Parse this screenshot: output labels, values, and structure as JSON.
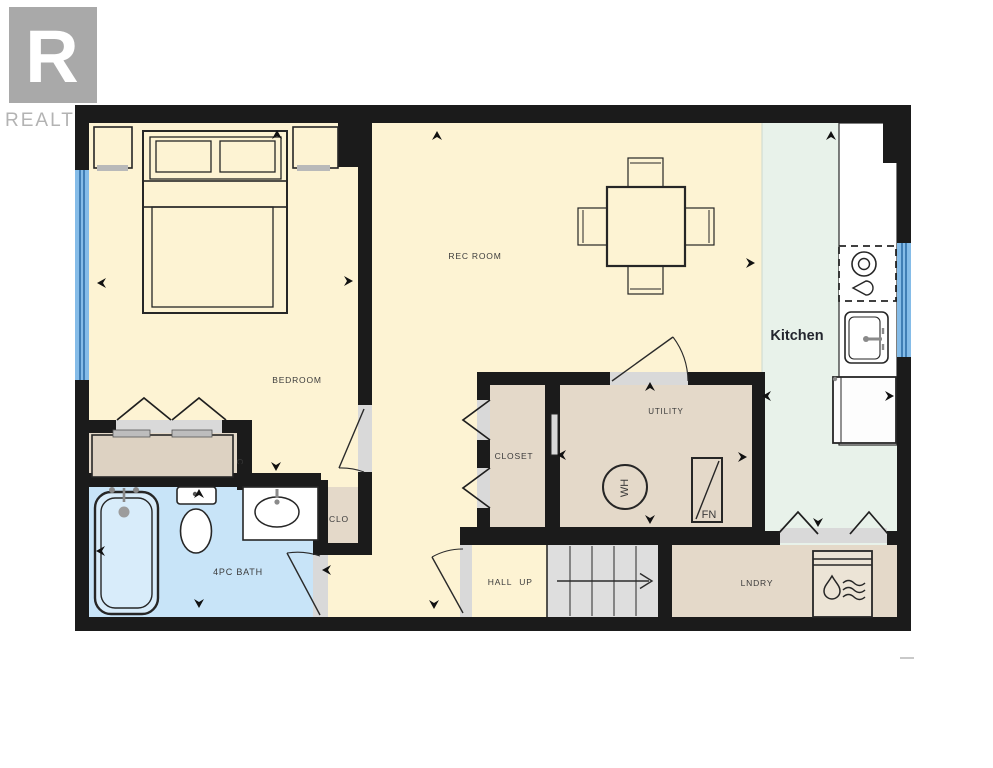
{
  "logo": {
    "letter": "R",
    "brand": "REALTOR",
    "registered_mark": "®"
  },
  "labels": {
    "bedroom": "BEDROOM",
    "rec_room": "REC ROOM",
    "kitchen": "Kitchen",
    "utility": "UTILITY",
    "closet": "CLOSET",
    "closet_small": "CLO",
    "closet_letter": "C",
    "bathroom": "4PC BATH",
    "hall": "HALL",
    "up": "UP",
    "laundry": "LNDRY",
    "water_heater": "WH",
    "furnace": "FN"
  },
  "colors": {
    "wall": "#1b1b1b",
    "floor_main": "#fdf3d3",
    "floor_service": "#e4d9c9",
    "floor_kitchen": "#e8f2ea",
    "floor_bath": "#c8e4f8",
    "counter_white": "#ffffff",
    "window_fill": "#85bce8",
    "window_line": "#2f6ea8",
    "stairs": "#dedede",
    "opening": "#d9d9d9",
    "fixture_line": "#262626",
    "arrow": "#111111",
    "logo_box": "#a9a9a9",
    "logo_text": "#b3b3b3",
    "label_text": "#3b3b3b",
    "kitchen_text": "#23262e"
  }
}
